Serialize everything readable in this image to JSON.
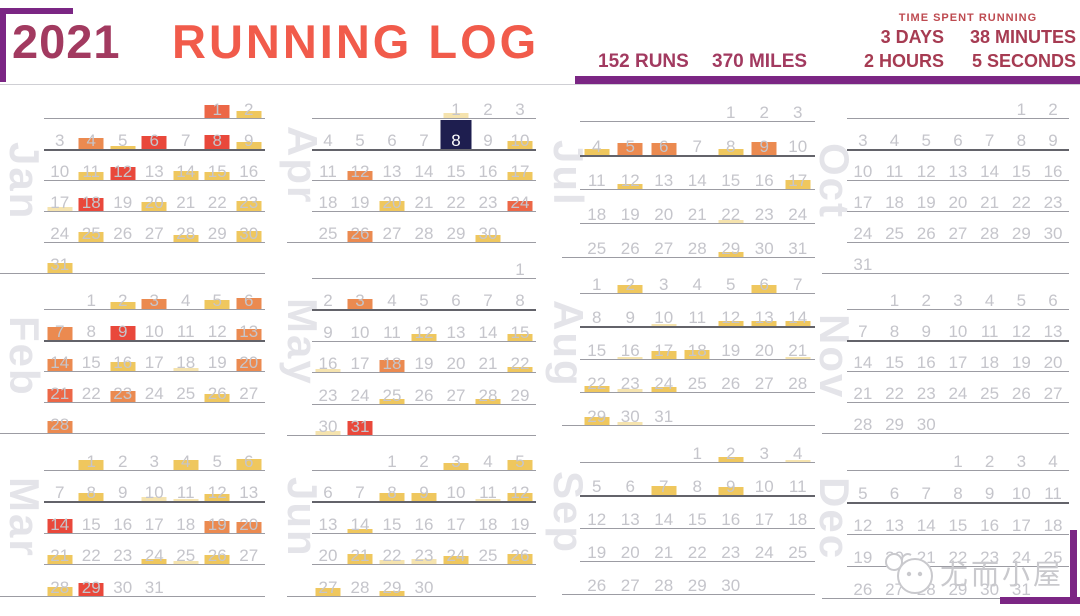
{
  "header": {
    "year": "2021",
    "title": "RUNNING LOG",
    "runs": "152 RUNS",
    "miles": "370 MILES",
    "time_label": "TIME SPENT RUNNING",
    "time_values": [
      "3 DAYS",
      "38 MINUTES",
      "2 HOURS",
      "5 SECONDS"
    ]
  },
  "watermark": {
    "text": "尤而小屋"
  },
  "colors": {
    "accent_purple": "#7B2684",
    "maroon": "#A23A60",
    "coral": "#F15B4B",
    "time_text": "#A63B52",
    "pale": "#F5E3AE",
    "yellow": "#EFC75E",
    "orange": "#EB8A50",
    "orangered": "#EC6747",
    "red": "#E9483B",
    "selected": "#1E1E4F"
  },
  "chart_data": {
    "type": "heatmap",
    "subtype": "calendar-running-log",
    "title": "2021 RUNNING LOG",
    "year": 2021,
    "week_starts": "Sunday",
    "totals": {
      "runs": 152,
      "miles": 370,
      "time_spent": "3 days 2 hours 38 minutes 5 seconds"
    },
    "selected_date": "2021-04-08",
    "intensity_encoding": "bar height h (px, 0-14) = relative run length; color ramp pale < yellow < orange < orangered < red; c=selected marks highlighted day",
    "columns_order": [
      [
        "Jan",
        "Feb",
        "Mar"
      ],
      [
        "Apr",
        "May",
        "Jun"
      ],
      [
        "Jul",
        "Aug",
        "Sep"
      ],
      [
        "Oct",
        "Nov",
        "Dec"
      ]
    ],
    "months": [
      {
        "name": "Jan",
        "first_weekday": 5,
        "num_days": 31,
        "runs": [
          {
            "day": 1,
            "h": 13,
            "c": "orangered"
          },
          {
            "day": 2,
            "h": 7,
            "c": "yellow"
          },
          {
            "day": 4,
            "h": 11,
            "c": "orange"
          },
          {
            "day": 5,
            "h": 3,
            "c": "yellow"
          },
          {
            "day": 6,
            "h": 13,
            "c": "red"
          },
          {
            "day": 8,
            "h": 14,
            "c": "red"
          },
          {
            "day": 9,
            "h": 7,
            "c": "yellow"
          },
          {
            "day": 11,
            "h": 8,
            "c": "yellow"
          },
          {
            "day": 12,
            "h": 13,
            "c": "red"
          },
          {
            "day": 14,
            "h": 9,
            "c": "yellow"
          },
          {
            "day": 15,
            "h": 8,
            "c": "yellow"
          },
          {
            "day": 17,
            "h": 4,
            "c": "pale"
          },
          {
            "day": 18,
            "h": 13,
            "c": "red"
          },
          {
            "day": 20,
            "h": 9,
            "c": "yellow"
          },
          {
            "day": 23,
            "h": 10,
            "c": "yellow"
          },
          {
            "day": 25,
            "h": 10,
            "c": "yellow"
          },
          {
            "day": 28,
            "h": 7,
            "c": "yellow"
          },
          {
            "day": 30,
            "h": 11,
            "c": "yellow"
          },
          {
            "day": 31,
            "h": 10,
            "c": "yellow"
          }
        ]
      },
      {
        "name": "Feb",
        "first_weekday": 1,
        "num_days": 28,
        "runs": [
          {
            "day": 2,
            "h": 7,
            "c": "yellow"
          },
          {
            "day": 3,
            "h": 10,
            "c": "orange"
          },
          {
            "day": 5,
            "h": 9,
            "c": "yellow"
          },
          {
            "day": 6,
            "h": 11,
            "c": "orange"
          },
          {
            "day": 7,
            "h": 13,
            "c": "orange"
          },
          {
            "day": 9,
            "h": 14,
            "c": "red"
          },
          {
            "day": 13,
            "h": 11,
            "c": "orange"
          },
          {
            "day": 14,
            "h": 12,
            "c": "orange"
          },
          {
            "day": 16,
            "h": 9,
            "c": "yellow"
          },
          {
            "day": 18,
            "h": 3,
            "c": "pale"
          },
          {
            "day": 20,
            "h": 12,
            "c": "orange"
          },
          {
            "day": 21,
            "h": 13,
            "c": "orangered"
          },
          {
            "day": 23,
            "h": 11,
            "c": "orange"
          },
          {
            "day": 26,
            "h": 8,
            "c": "yellow"
          },
          {
            "day": 28,
            "h": 12,
            "c": "orange"
          }
        ]
      },
      {
        "name": "Mar",
        "first_weekday": 1,
        "num_days": 31,
        "runs": [
          {
            "day": 1,
            "h": 10,
            "c": "yellow"
          },
          {
            "day": 4,
            "h": 10,
            "c": "yellow"
          },
          {
            "day": 6,
            "h": 11,
            "c": "yellow"
          },
          {
            "day": 8,
            "h": 8,
            "c": "yellow"
          },
          {
            "day": 10,
            "h": 4,
            "c": "pale"
          },
          {
            "day": 11,
            "h": 2,
            "c": "pale"
          },
          {
            "day": 12,
            "h": 7,
            "c": "yellow"
          },
          {
            "day": 14,
            "h": 14,
            "c": "red"
          },
          {
            "day": 19,
            "h": 12,
            "c": "orange"
          },
          {
            "day": 20,
            "h": 11,
            "c": "orange"
          },
          {
            "day": 21,
            "h": 9,
            "c": "yellow"
          },
          {
            "day": 24,
            "h": 5,
            "c": "yellow"
          },
          {
            "day": 25,
            "h": 3,
            "c": "pale"
          },
          {
            "day": 26,
            "h": 9,
            "c": "yellow"
          },
          {
            "day": 28,
            "h": 9,
            "c": "yellow"
          },
          {
            "day": 29,
            "h": 13,
            "c": "red"
          }
        ]
      },
      {
        "name": "Apr",
        "first_weekday": 4,
        "num_days": 30,
        "runs": [
          {
            "day": 1,
            "h": 5,
            "c": "pale"
          },
          {
            "day": 8,
            "h": 30,
            "c": "selected"
          },
          {
            "day": 10,
            "h": 8,
            "c": "yellow"
          },
          {
            "day": 12,
            "h": 9,
            "c": "orange"
          },
          {
            "day": 17,
            "h": 8,
            "c": "yellow"
          },
          {
            "day": 20,
            "h": 10,
            "c": "yellow"
          },
          {
            "day": 24,
            "h": 10,
            "c": "orangered"
          },
          {
            "day": 26,
            "h": 11,
            "c": "orange"
          },
          {
            "day": 30,
            "h": 7,
            "c": "yellow"
          }
        ]
      },
      {
        "name": "May",
        "first_weekday": 6,
        "num_days": 31,
        "runs": [
          {
            "day": 3,
            "h": 10,
            "c": "orange"
          },
          {
            "day": 12,
            "h": 7,
            "c": "yellow"
          },
          {
            "day": 15,
            "h": 7,
            "c": "yellow"
          },
          {
            "day": 16,
            "h": 3,
            "c": "pale"
          },
          {
            "day": 18,
            "h": 12,
            "c": "orange"
          },
          {
            "day": 22,
            "h": 5,
            "c": "yellow"
          },
          {
            "day": 25,
            "h": 5,
            "c": "yellow"
          },
          {
            "day": 28,
            "h": 5,
            "c": "yellow"
          },
          {
            "day": 30,
            "h": 4,
            "c": "pale"
          },
          {
            "day": 31,
            "h": 14,
            "c": "red"
          }
        ]
      },
      {
        "name": "Jun",
        "first_weekday": 2,
        "num_days": 30,
        "runs": [
          {
            "day": 3,
            "h": 7,
            "c": "yellow"
          },
          {
            "day": 5,
            "h": 10,
            "c": "yellow"
          },
          {
            "day": 8,
            "h": 8,
            "c": "yellow"
          },
          {
            "day": 9,
            "h": 8,
            "c": "yellow"
          },
          {
            "day": 11,
            "h": 2,
            "c": "pale"
          },
          {
            "day": 12,
            "h": 8,
            "c": "yellow"
          },
          {
            "day": 14,
            "h": 4,
            "c": "yellow"
          },
          {
            "day": 21,
            "h": 10,
            "c": "yellow"
          },
          {
            "day": 22,
            "h": 4,
            "c": "pale"
          },
          {
            "day": 23,
            "h": 5,
            "c": "pale"
          },
          {
            "day": 24,
            "h": 8,
            "c": "yellow"
          },
          {
            "day": 26,
            "h": 10,
            "c": "yellow"
          },
          {
            "day": 27,
            "h": 8,
            "c": "yellow"
          },
          {
            "day": 29,
            "h": 5,
            "c": "yellow"
          }
        ]
      },
      {
        "name": "Jul",
        "first_weekday": 4,
        "num_days": 31,
        "runs": [
          {
            "day": 4,
            "h": 6,
            "c": "yellow"
          },
          {
            "day": 5,
            "h": 12,
            "c": "orange"
          },
          {
            "day": 6,
            "h": 12,
            "c": "orange"
          },
          {
            "day": 8,
            "h": 6,
            "c": "yellow"
          },
          {
            "day": 9,
            "h": 13,
            "c": "orange"
          },
          {
            "day": 12,
            "h": 5,
            "c": "yellow"
          },
          {
            "day": 17,
            "h": 9,
            "c": "yellow"
          },
          {
            "day": 22,
            "h": 3,
            "c": "pale"
          },
          {
            "day": 29,
            "h": 5,
            "c": "yellow"
          }
        ]
      },
      {
        "name": "Aug",
        "first_weekday": 0,
        "num_days": 31,
        "runs": [
          {
            "day": 2,
            "h": 8,
            "c": "yellow"
          },
          {
            "day": 6,
            "h": 8,
            "c": "yellow"
          },
          {
            "day": 10,
            "h": 2,
            "c": "pale"
          },
          {
            "day": 12,
            "h": 5,
            "c": "yellow"
          },
          {
            "day": 13,
            "h": 5,
            "c": "yellow"
          },
          {
            "day": 14,
            "h": 5,
            "c": "yellow"
          },
          {
            "day": 16,
            "h": 2,
            "c": "pale"
          },
          {
            "day": 17,
            "h": 8,
            "c": "yellow"
          },
          {
            "day": 18,
            "h": 9,
            "c": "yellow"
          },
          {
            "day": 21,
            "h": 2,
            "c": "pale"
          },
          {
            "day": 22,
            "h": 6,
            "c": "yellow"
          },
          {
            "day": 23,
            "h": 3,
            "c": "pale"
          },
          {
            "day": 24,
            "h": 5,
            "c": "yellow"
          },
          {
            "day": 29,
            "h": 8,
            "c": "yellow"
          },
          {
            "day": 30,
            "h": 3,
            "c": "pale"
          }
        ]
      },
      {
        "name": "Sep",
        "first_weekday": 3,
        "num_days": 30,
        "runs": [
          {
            "day": 2,
            "h": 5,
            "c": "yellow"
          },
          {
            "day": 4,
            "h": 2,
            "c": "pale"
          },
          {
            "day": 7,
            "h": 9,
            "c": "yellow"
          },
          {
            "day": 9,
            "h": 8,
            "c": "yellow"
          }
        ]
      },
      {
        "name": "Oct",
        "first_weekday": 5,
        "num_days": 31,
        "runs": []
      },
      {
        "name": "Nov",
        "first_weekday": 1,
        "num_days": 30,
        "runs": []
      },
      {
        "name": "Dec",
        "first_weekday": 3,
        "num_days": 31,
        "runs": []
      }
    ]
  }
}
